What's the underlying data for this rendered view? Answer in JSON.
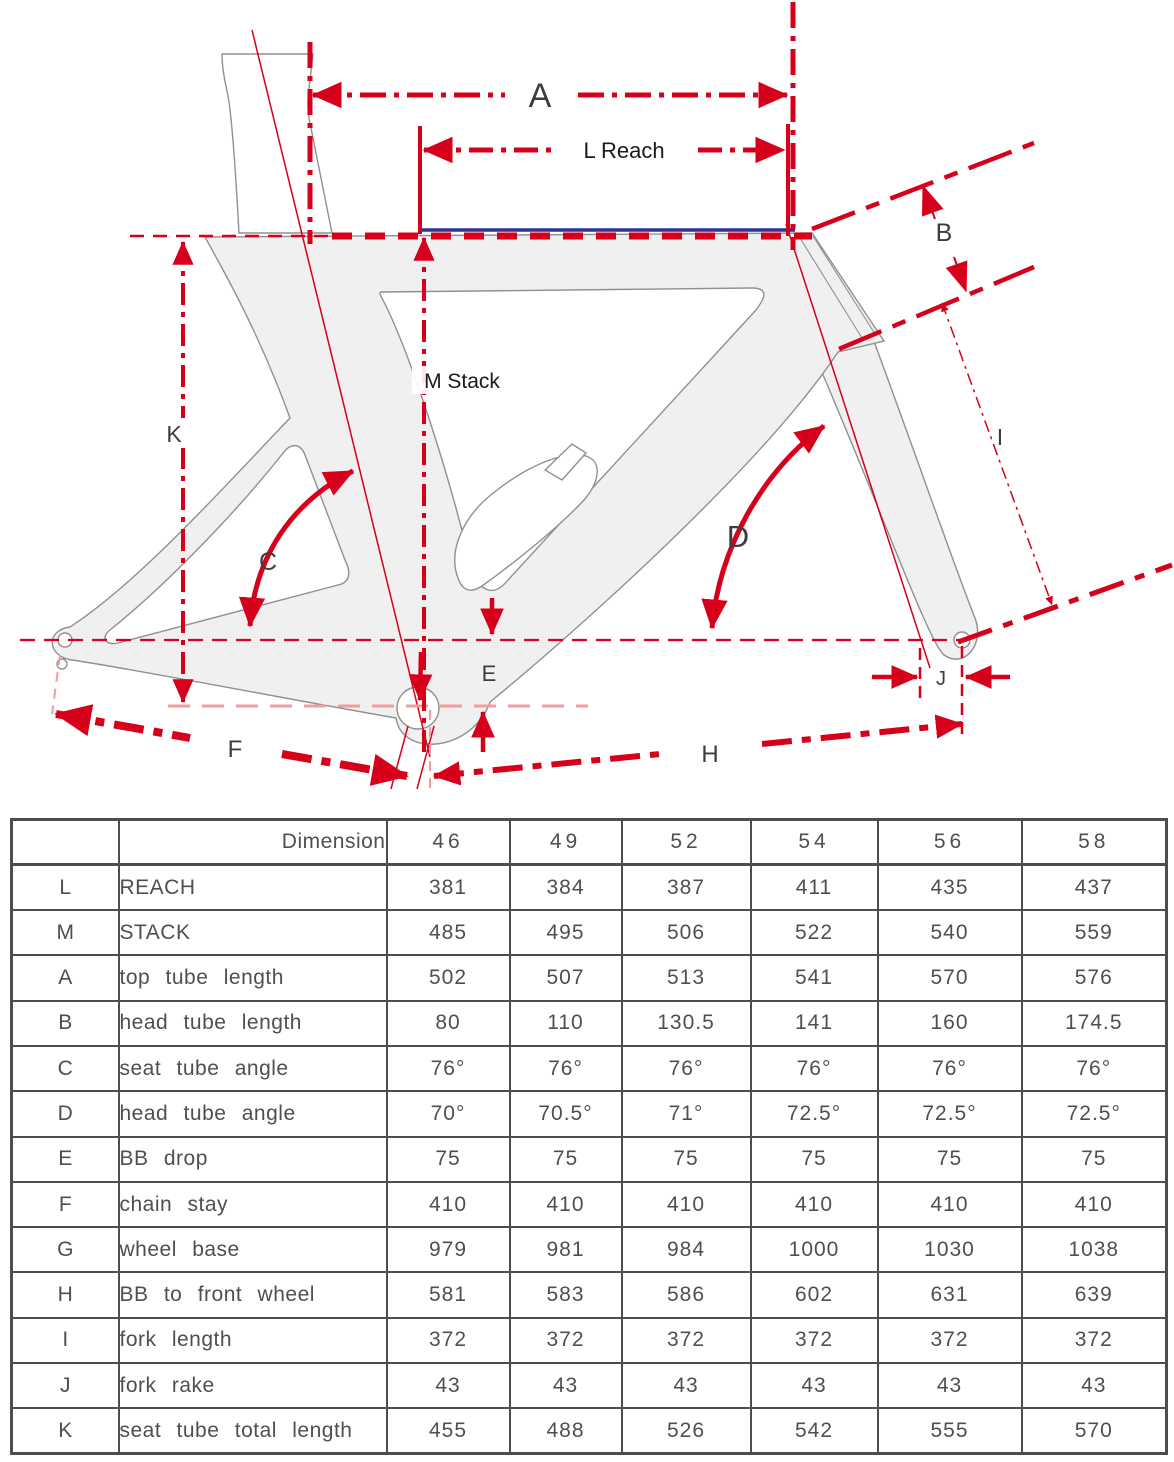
{
  "diagram": {
    "labels": {
      "A": "A",
      "B": "B",
      "C": "C",
      "D": "D",
      "E": "E",
      "F": "F",
      "H": "H",
      "I": "I",
      "J": "J",
      "K": "K",
      "reach": "L Reach",
      "stack": "M Stack"
    },
    "colors": {
      "red": "#d6001b",
      "salmon": "#ef9d9d",
      "navy": "#2e3192",
      "frame_fill": "#f0f0f1",
      "frame_stroke": "#909090",
      "label_gray": "#3d3d3d",
      "table_line": "#4d4d4d",
      "table_text": "#4f4f4f"
    }
  },
  "table": {
    "header": {
      "corner": "",
      "dimension": "Dimension",
      "sizes": [
        "46",
        "49",
        "52",
        "54",
        "56",
        "58"
      ]
    },
    "rows": [
      {
        "key": "L",
        "label": "REACH",
        "values": [
          "381",
          "384",
          "387",
          "411",
          "435",
          "437"
        ]
      },
      {
        "key": "M",
        "label": "STACK",
        "values": [
          "485",
          "495",
          "506",
          "522",
          "540",
          "559"
        ]
      },
      {
        "key": "A",
        "label": "top tube length",
        "values": [
          "502",
          "507",
          "513",
          "541",
          "570",
          "576"
        ]
      },
      {
        "key": "B",
        "label": "head tube length",
        "values": [
          "80",
          "110",
          "130.5",
          "141",
          "160",
          "174.5"
        ]
      },
      {
        "key": "C",
        "label": "seat tube angle",
        "values": [
          "76°",
          "76°",
          "76°",
          "76°",
          "76°",
          "76°"
        ]
      },
      {
        "key": "D",
        "label": "head tube angle",
        "values": [
          "70°",
          "70.5°",
          "71°",
          "72.5°",
          "72.5°",
          "72.5°"
        ]
      },
      {
        "key": "E",
        "label": "BB drop",
        "values": [
          "75",
          "75",
          "75",
          "75",
          "75",
          "75"
        ]
      },
      {
        "key": "F",
        "label": "chain stay",
        "values": [
          "410",
          "410",
          "410",
          "410",
          "410",
          "410"
        ]
      },
      {
        "key": "G",
        "label": "wheel base",
        "values": [
          "979",
          "981",
          "984",
          "1000",
          "1030",
          "1038"
        ]
      },
      {
        "key": "H",
        "label": "BB to front wheel",
        "values": [
          "581",
          "583",
          "586",
          "602",
          "631",
          "639"
        ]
      },
      {
        "key": "I",
        "label": "fork length",
        "values": [
          "372",
          "372",
          "372",
          "372",
          "372",
          "372"
        ]
      },
      {
        "key": "J",
        "label": "fork rake",
        "values": [
          "43",
          "43",
          "43",
          "43",
          "43",
          "43"
        ]
      },
      {
        "key": "K",
        "label": "seat tube total length",
        "values": [
          "455",
          "488",
          "526",
          "542",
          "555",
          "570"
        ]
      }
    ]
  }
}
